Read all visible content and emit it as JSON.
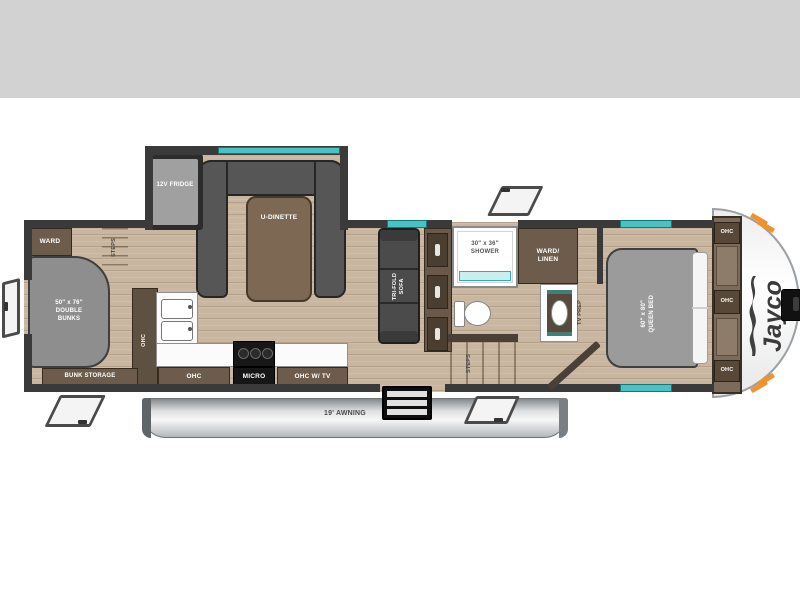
{
  "header": {
    "band_color": "#d2d2d2"
  },
  "floorplan": {
    "brand": {
      "logo_text": "Jayco"
    },
    "exterior": {
      "awning_label": "19' AWNING"
    },
    "bunk_room": {
      "ward_label": "WARD",
      "steps_label": "STEPS",
      "bunks_lines": [
        "50\" x 76\"",
        "DOUBLE",
        "BUNKS"
      ],
      "bunk_storage_label": "BUNK STORAGE"
    },
    "dinette_slide": {
      "fridge_label": "12V FRIDGE",
      "dinette_label": "U-DINETTE"
    },
    "kitchen": {
      "tall_cabinet_label": "OHC",
      "ohc_label": "OHC",
      "micro_label": "MICRO",
      "ohc_tv_label": "OHC W/ TV"
    },
    "living": {
      "sofa_lines": [
        "TRI-FOLD",
        "SOFA"
      ]
    },
    "bathroom": {
      "shower_lines": [
        "30\" x 36\"",
        "SHOWER"
      ],
      "ward_linen_lines": [
        "WARD/",
        "LINEN"
      ],
      "steps_label": "STEPS"
    },
    "bedroom": {
      "tv_prep_label": "TV PREP",
      "bed_lines": [
        "60\" x 80\"",
        "QUEEN BED"
      ],
      "ohc_labels": [
        "OHC",
        "OHC",
        "OHC"
      ]
    },
    "colors": {
      "wall": "#3a3a3a",
      "floor_wood": "#c9b6a0",
      "cabinet_brown": "#6d5c4b",
      "cushion_gray": "#8e8e8e",
      "window_teal": "#3fbdbf",
      "accent_orange": "#f0922e",
      "awning_silver": "#c7c9cb"
    }
  }
}
